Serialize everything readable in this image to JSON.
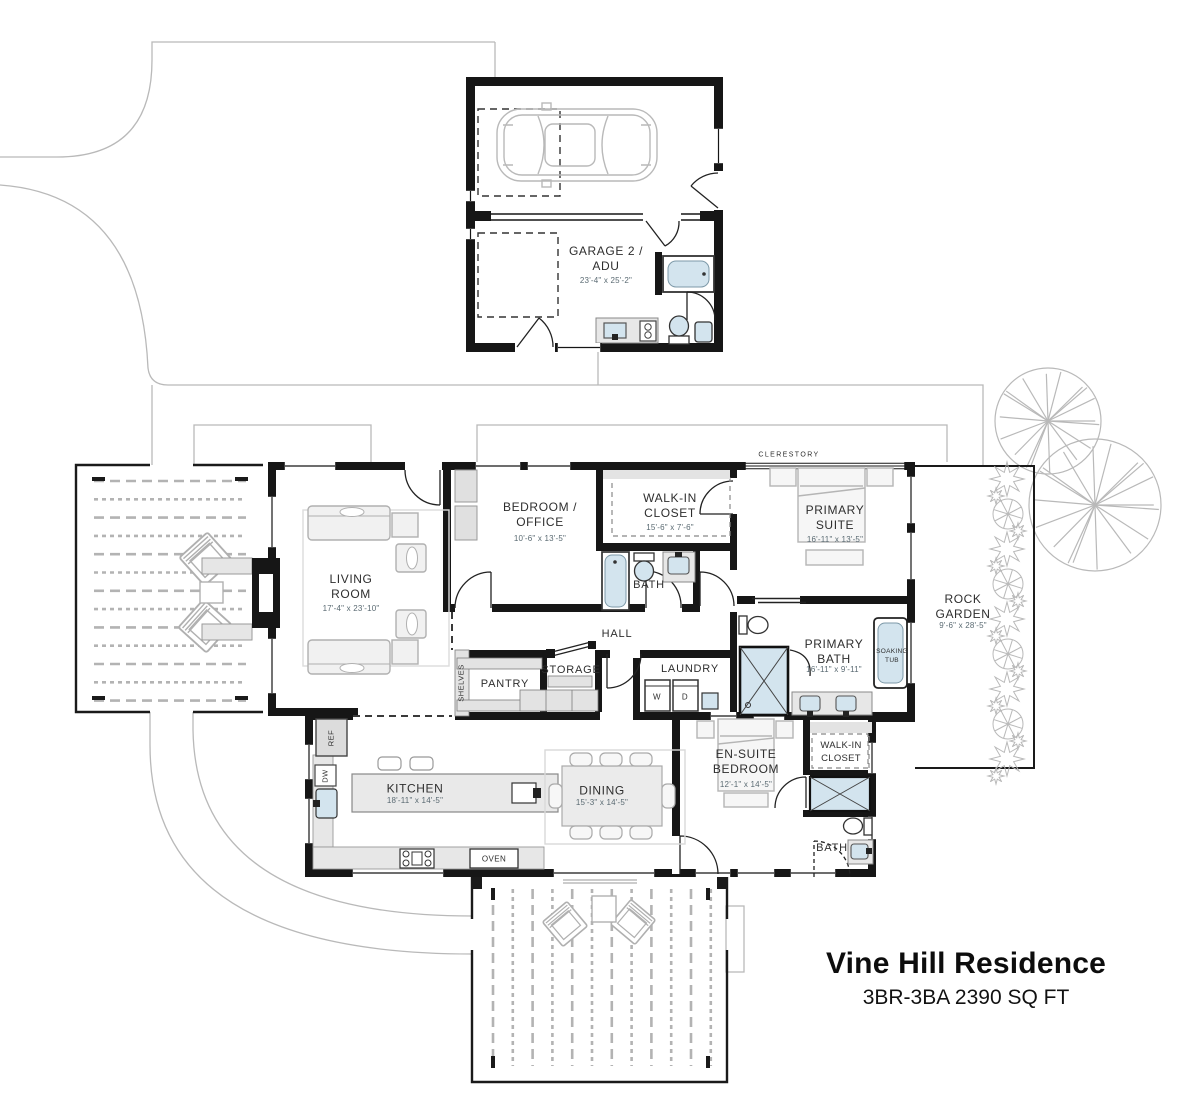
{
  "title": {
    "name": "Vine Hill Residence",
    "specs": "3BR-3BA 2390 SQ FT"
  },
  "labels": {
    "garage": {
      "lines": [
        "GARAGE 2 /",
        "ADU"
      ],
      "dims": "23'-4\" x 25'-2\""
    },
    "living": {
      "lines": [
        "LIVING",
        "ROOM"
      ],
      "dims": "17'-4\" x 23'-10\""
    },
    "bedroom_office": {
      "lines": [
        "BEDROOM /",
        "OFFICE"
      ],
      "dims": "10'-6\" x 13'-5\""
    },
    "walk_in_closet_1": {
      "lines": [
        "WALK-IN",
        "CLOSET"
      ],
      "dims": "15'-6\" x 7'-6\""
    },
    "primary_suite": {
      "lines": [
        "PRIMARY",
        "SUITE"
      ],
      "dims": "16'-11\" x 13'-5\""
    },
    "primary_bath": {
      "lines": [
        "PRIMARY",
        "BATH"
      ],
      "dims": "16'-11\" x 9'-11\""
    },
    "rock_garden": {
      "lines": [
        "ROCK",
        "GARDEN"
      ],
      "dims": "9'-6\" x 28'-5\""
    },
    "kitchen": {
      "lines": [
        "KITCHEN"
      ],
      "dims": "18'-11\" x 14'-5\""
    },
    "dining": {
      "lines": [
        "DINING"
      ],
      "dims": "15'-3\" x 14'-5\""
    },
    "ensuite_bedroom": {
      "lines": [
        "EN-SUITE",
        "BEDROOM"
      ],
      "dims": "12'-1\" x 14'-5\""
    },
    "walk_in_closet_2": {
      "lines": [
        "WALK-IN",
        "CLOSET"
      ]
    },
    "bath_1": {
      "lines": [
        "BATH"
      ]
    },
    "bath_2": {
      "lines": [
        "BATH"
      ]
    },
    "hall": {
      "lines": [
        "HALL"
      ]
    },
    "pant​ry": {
      "lines": [
        "PANTRY"
      ]
    },
    "pantry": {
      "lines": [
        "PANTRY"
      ]
    },
    "storage": {
      "lines": [
        "STORAGE"
      ]
    },
    "laundry": {
      "lines": [
        "LAUNDRY"
      ]
    },
    "clerestory": {
      "lines": [
        "CLERESTORY"
      ]
    },
    "soaking_tub": {
      "lines": [
        "SOAKING",
        "TUB"
      ]
    },
    "shelves": {
      "lines": [
        "SHELVES"
      ]
    },
    "washer": "W",
    "dryer": "D",
    "oven": "OVEN",
    "ref": "REF",
    "dishwasher": "DW"
  },
  "colors": {
    "wall": "#161616",
    "fixture_blue": "#d3e4ee",
    "counter_gray": "#e7e7e7",
    "furniture_line": "#b0b0b0",
    "site_line": "#b9b9b9",
    "label_text": "#2e2e2e",
    "dim_text": "#5a6a72"
  }
}
